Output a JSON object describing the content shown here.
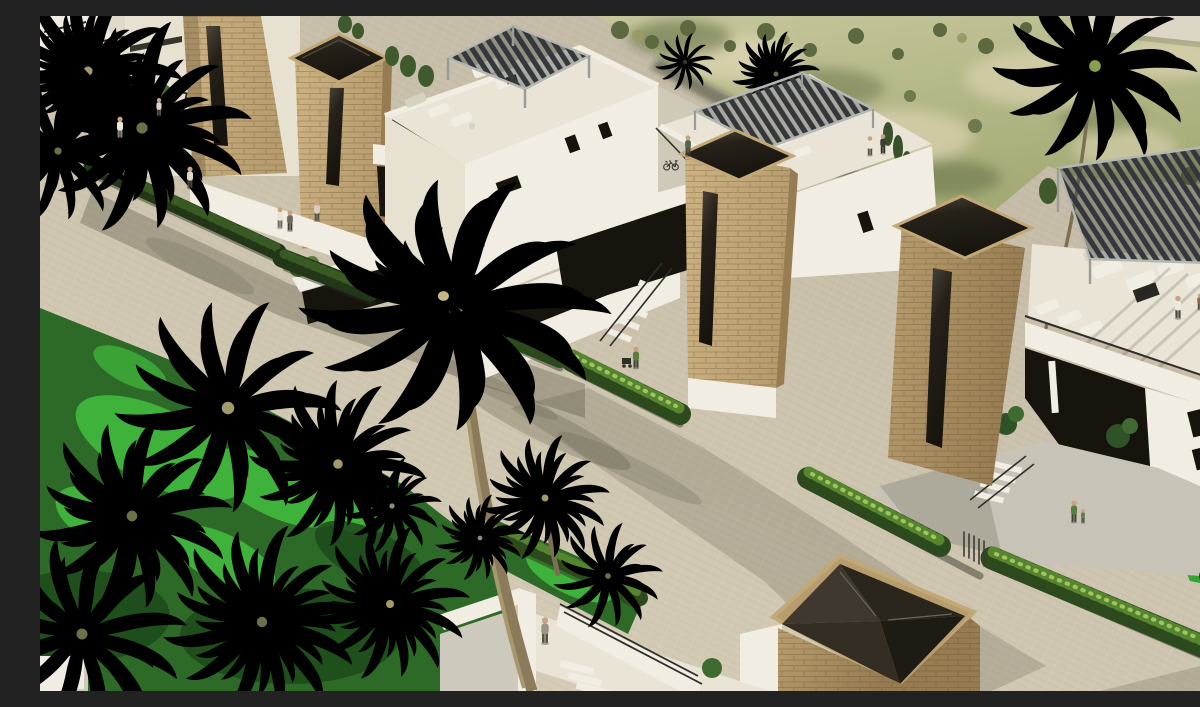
{
  "scene": {
    "description": "Aerial 3D architectural rendering of a modern villa development: white cubic villas with natural stone towers and rooftop pergola terraces along a paved street, tropical gardens with palm trees in the foreground, trimmed hedges, small human figures, and a golf course landscape in the background.",
    "elements": [
      "golf-course-background",
      "sand-path",
      "background-palm",
      "street",
      "left-garden",
      "villa-top-left",
      "villa-with-roof-lounge",
      "villa-middle-wing",
      "villa-right-terrace",
      "stone-tower",
      "glass-pyramid-skylight-tower",
      "stair-building-corner",
      "hedge-rows",
      "palm-trees",
      "pedestrians",
      "rooftop-pergola",
      "sun-loungers",
      "outdoor-sofa"
    ],
    "counts": {
      "stone_towers": 5,
      "pergolas": 3,
      "people_visible": 17,
      "palm_trees": 14
    }
  },
  "palette": {
    "pavementLight": "#d9d0ba",
    "pavementDark": "#c2b9a4",
    "golfBase": "#a3aa74",
    "golfLight": "#c6c69c",
    "golfSand": "#dbd4b2",
    "golfDark": "#5d6940",
    "sandPath": "#dcd6c6",
    "wallWhite": "#f1ede2",
    "wallCream": "#e6e1d1",
    "wallShade": "#cfc9b8",
    "terrace": "#e9e4d5",
    "forecourt": "#c7c3b7",
    "stoneLight": "#cdb383",
    "stoneMid": "#b79d6e",
    "stoneDark": "#977c52",
    "stoneEdge": "#786343",
    "capRim": "#c2a877",
    "glassDark": "#17140e",
    "glassMid": "#26221a",
    "glassSheen": "#4e483c",
    "pergolaDark": "#34383b",
    "pergolaFrame": "#b5b7b3",
    "hedgeBase": "#2c4a1d",
    "hedgeLight": "#55852f",
    "hedgeSpeck": "#a2c45e",
    "ivyBase": "#223618",
    "ivyLight": "#3a5a24",
    "grassBase": "#2e6a27",
    "grassBright": "#3eb23a",
    "grassDark": "#1c4a1a",
    "lawn": "#35a233",
    "palmKhakiD": "#5c5c3a",
    "palmKhakiL": "#a29a6a",
    "palmOliveD": "#333b25",
    "palmOliveL": "#68714a",
    "palmGreenD": "#46622e",
    "palmGreenL": "#87a04c",
    "palmGrayD": "#5e624c",
    "palmGrayL": "#8f9076",
    "trunk": "#8b7b5a",
    "trunkHi": "#a8986f",
    "trunkBg": "#7d6f52",
    "furniture": "#f0ede2",
    "furnitureShade": "#d6d2c2",
    "tableDark": "#2a2824",
    "railBlack": "#2e2e2a",
    "skin": "#c9a183",
    "shadow": "rgba(84,82,64,0.34)",
    "shadowSoft": "rgba(84,82,64,0.22)",
    "shadowDeep": "rgba(40,42,28,0.45)"
  }
}
